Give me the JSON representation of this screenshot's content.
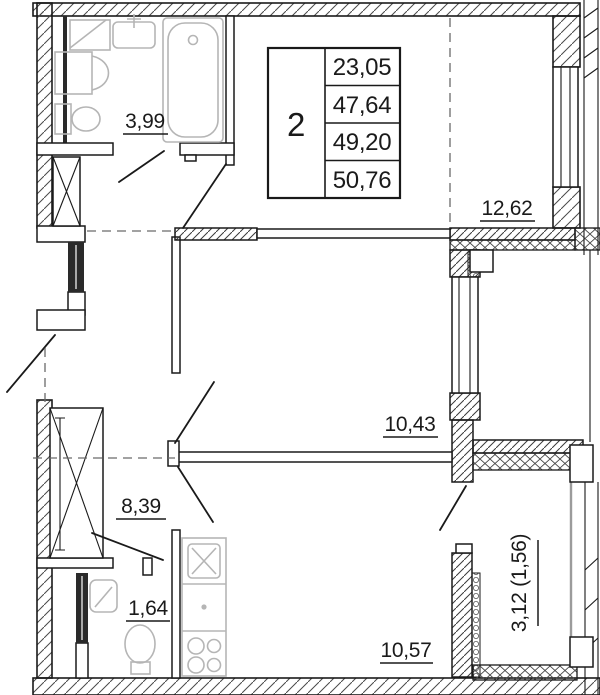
{
  "info_table": {
    "rooms_count": "2",
    "areas": [
      "23,05",
      "47,64",
      "49,20",
      "50,76"
    ]
  },
  "room_labels": {
    "bathroom": "3,99",
    "living_room": "12,62",
    "bedroom": "10,43",
    "hallway": "8,39",
    "wc": "1,64",
    "kitchen": "10,57",
    "balcony": "3,12 (1,56)"
  },
  "colors": {
    "line": "#1a1a1a",
    "fixture": "#b5b5b5",
    "glazing": "#9b9b9b",
    "background": "#ffffff"
  }
}
